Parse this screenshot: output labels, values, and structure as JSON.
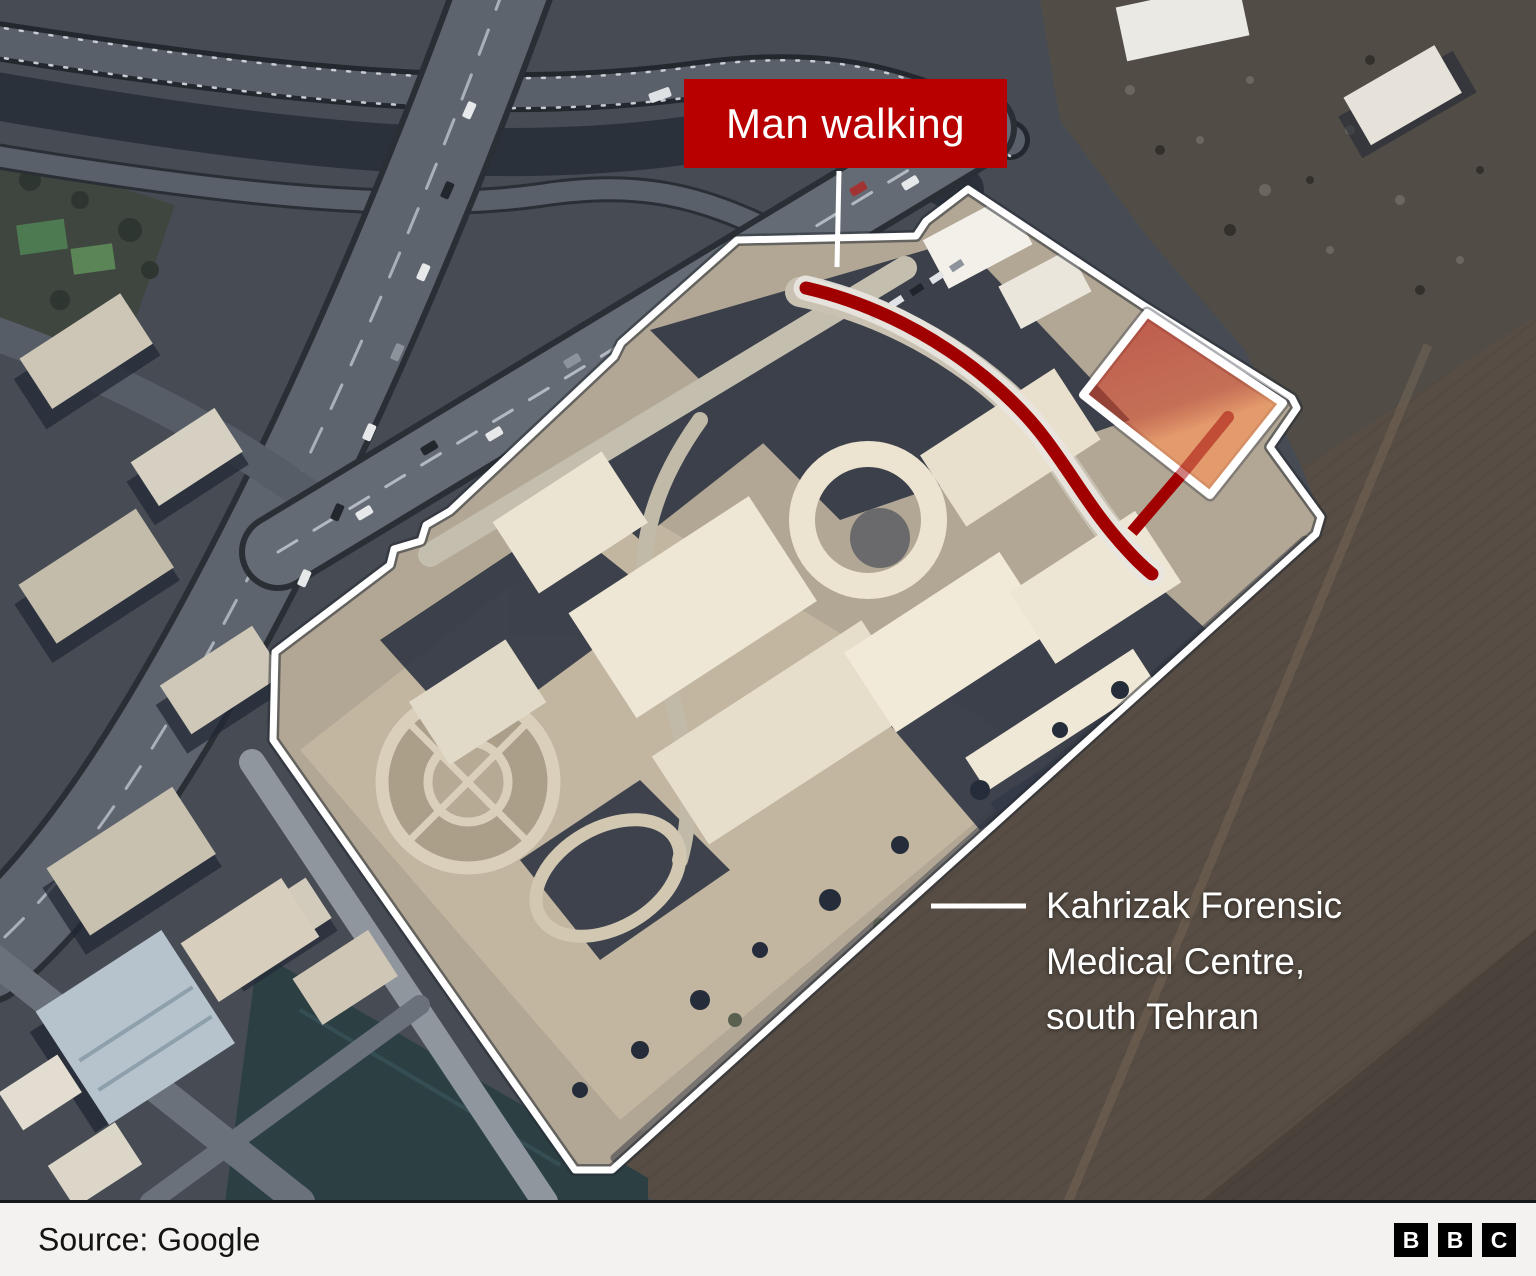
{
  "map": {
    "callout": {
      "label": "Man walking",
      "bg_color": "#b80000",
      "text_color": "#ffffff"
    },
    "facility_label": {
      "line1": "Kahrizak Forensic",
      "line2": "Medical Centre,",
      "line3": "south Tehran",
      "text_color": "#ffffff"
    },
    "colors": {
      "walking_path": "#a00000",
      "path_halo": "#e8e5e0",
      "boundary": "#ffffff",
      "highlight_red": "#c63023",
      "highlight_orange": "#f6965c"
    }
  },
  "footer": {
    "source": "Source: Google",
    "bg_color": "#f3f2f0",
    "text_color": "#141414",
    "logo": {
      "letters": [
        "B",
        "B",
        "C"
      ],
      "block_color": "#000000",
      "letter_color": "#ffffff"
    }
  }
}
